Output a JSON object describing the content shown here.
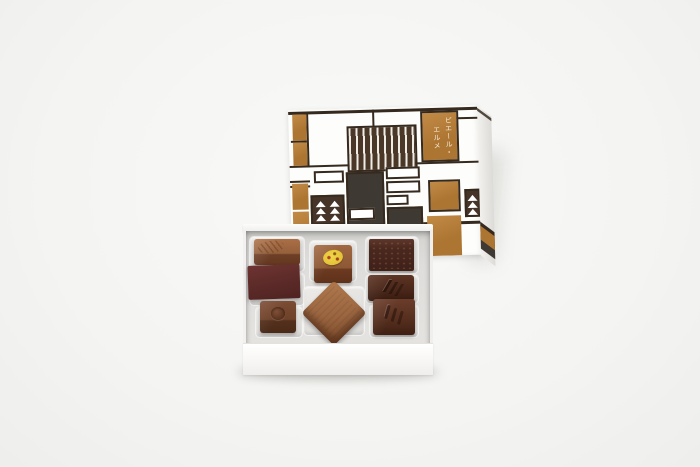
{
  "lid": {
    "brand_text_columns": [
      "ピエール・",
      "エルメ"
    ],
    "motifs": [
      "mondrian-grid",
      "vertical-stripes",
      "fir-tree"
    ]
  },
  "box": {
    "count": 8,
    "chocolates": [
      {
        "id": "milk-square-comb"
      },
      {
        "id": "dark-matte-slab"
      },
      {
        "id": "milk-rect-dimple"
      },
      {
        "id": "milk-square-yellow-disc"
      },
      {
        "id": "milk-diamond"
      },
      {
        "id": "dark-matte-brownie"
      },
      {
        "id": "dark-chevron"
      },
      {
        "id": "dark-claw"
      }
    ]
  },
  "colors": {
    "background": "#f4f4f2",
    "lid_white": "#fdfdfb",
    "line": "#362a1f",
    "caramel": "#ad7532",
    "caramel_light": "#c18a45",
    "stripe_bg": "#4a3727",
    "stripe_light": "#efece6",
    "charcoal": "#3f3933",
    "fir_brown": "#463428",
    "yellow": "#e4c335"
  }
}
